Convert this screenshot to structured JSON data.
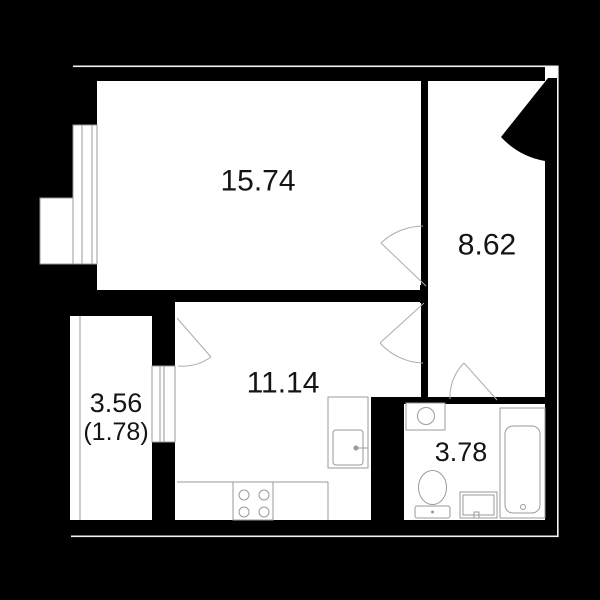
{
  "plan": {
    "canvas": {
      "width": 600,
      "height": 600,
      "background": "#000000"
    },
    "colors": {
      "floor": "#ffffff",
      "wall": "#000000",
      "fixture_line": "#9a9a9a",
      "door_line": "#ababab",
      "outer_hairline": "#f5f5f5",
      "label_text": "#141414"
    },
    "rooms": [
      {
        "name": "living-room",
        "label": "15.74",
        "label_x": 258,
        "label_y": 181,
        "label_size": 30
      },
      {
        "name": "hallway",
        "label": "8.62",
        "label_x": 487,
        "label_y": 245,
        "label_size": 30
      },
      {
        "name": "kitchen",
        "label": "11.14",
        "label_x": 283,
        "label_y": 383,
        "label_size": 30
      },
      {
        "name": "bathroom",
        "label": "3.78",
        "label_x": 461,
        "label_y": 452,
        "label_size": 27
      },
      {
        "name": "balcony",
        "label": "3.56",
        "label_x": 116,
        "label_y": 403,
        "label_size": 27,
        "label2": "(1.78)",
        "label2_x": 116,
        "label2_y": 432,
        "label2_size": 25
      }
    ],
    "shapes": [
      {
        "t": "rect",
        "name": "living-room-floor",
        "x": 97,
        "y": 81,
        "w": 324,
        "h": 209,
        "fill": "floor"
      },
      {
        "t": "rect",
        "name": "hallway-floor",
        "x": 428,
        "y": 81,
        "w": 117,
        "h": 316,
        "fill": "floor"
      },
      {
        "t": "rect",
        "name": "kitchen-floor",
        "x": 175,
        "y": 302,
        "w": 246,
        "h": 218,
        "fill": "floor"
      },
      {
        "t": "rect",
        "name": "balcony-floor",
        "x": 70,
        "y": 316,
        "w": 82,
        "h": 204,
        "fill": "floor"
      },
      {
        "t": "rect",
        "name": "bathroom-floor",
        "x": 404,
        "y": 404,
        "w": 141,
        "h": 117,
        "fill": "floor"
      },
      {
        "t": "rect",
        "name": "wall-top",
        "x": 73,
        "y": 67,
        "w": 472,
        "h": 14,
        "fill": "wall"
      },
      {
        "t": "rect",
        "name": "wall-left-upper",
        "x": 73,
        "y": 81,
        "w": 24,
        "h": 45,
        "fill": "wall"
      },
      {
        "t": "rect",
        "name": "wall-left-lower",
        "x": 73,
        "y": 264,
        "w": 24,
        "h": 26,
        "fill": "wall"
      },
      {
        "t": "rect",
        "name": "wall-living-balcony",
        "x": 70,
        "y": 290,
        "w": 105,
        "h": 26,
        "fill": "wall"
      },
      {
        "t": "rect",
        "name": "wall-balcony-pier-top",
        "x": 152,
        "y": 290,
        "w": 23,
        "h": 28,
        "fill": "wall"
      },
      {
        "t": "rect",
        "name": "wall-balcony-pier-bot",
        "x": 152,
        "y": 442,
        "w": 23,
        "h": 78,
        "fill": "wall"
      },
      {
        "t": "rect",
        "name": "wall-living-kitchen",
        "x": 175,
        "y": 290,
        "w": 253,
        "h": 12,
        "fill": "wall"
      },
      {
        "t": "rect",
        "name": "wall-hall-living",
        "x": 421,
        "y": 81,
        "w": 7,
        "h": 144,
        "fill": "wall"
      },
      {
        "t": "rect",
        "name": "wall-door-cap",
        "x": 420,
        "y": 285,
        "w": 8,
        "h": 18,
        "fill": "wall"
      },
      {
        "t": "rect",
        "name": "wall-hall-kitchen-stub",
        "x": 421,
        "y": 363,
        "w": 7,
        "h": 34,
        "fill": "wall"
      },
      {
        "t": "rect",
        "name": "wall-bottom",
        "x": 70,
        "y": 520,
        "w": 488,
        "h": 16,
        "fill": "wall"
      },
      {
        "t": "rect",
        "name": "wall-right",
        "x": 545,
        "y": 93,
        "w": 12,
        "h": 427,
        "fill": "wall"
      },
      {
        "t": "rect",
        "name": "wall-bath-top-left",
        "x": 371,
        "y": 397,
        "w": 76,
        "h": 7,
        "fill": "wall"
      },
      {
        "t": "rect",
        "name": "wall-bath-top-right",
        "x": 497,
        "y": 397,
        "w": 60,
        "h": 7,
        "fill": "wall"
      },
      {
        "t": "rect",
        "name": "duct-column",
        "x": 371,
        "y": 397,
        "w": 33,
        "h": 124,
        "fill": "wall"
      },
      {
        "t": "rect",
        "name": "entrance-opening",
        "x": 545,
        "y": 67,
        "w": 12,
        "h": 26,
        "fill": "floor"
      },
      {
        "t": "rect",
        "name": "window-living",
        "x": 73,
        "y": 125,
        "w": 24,
        "h": 139,
        "fill": "floor",
        "stroke": "fixture_line"
      },
      {
        "t": "line",
        "name": "window-living-mullion",
        "x1": 82,
        "y1": 125,
        "x2": 82,
        "y2": 264,
        "stroke": "fixture_line"
      },
      {
        "t": "line",
        "name": "window-living-mullion",
        "x1": 92,
        "y1": 125,
        "x2": 92,
        "y2": 264,
        "stroke": "fixture_line"
      },
      {
        "t": "rect",
        "name": "window-balcony",
        "x": 152,
        "y": 366,
        "w": 23,
        "h": 76,
        "fill": "floor",
        "stroke": "fixture_line"
      },
      {
        "t": "line",
        "name": "window-balcony-mullion",
        "x1": 160,
        "y1": 366,
        "x2": 160,
        "y2": 442,
        "stroke": "fixture_line"
      },
      {
        "t": "line",
        "name": "window-balcony-mullion",
        "x1": 164,
        "y1": 366,
        "x2": 164,
        "y2": 442,
        "stroke": "fixture_line"
      },
      {
        "t": "rect",
        "name": "exterior-ledge",
        "x": 40,
        "y": 198,
        "w": 33,
        "h": 66,
        "fill": "floor",
        "stroke": "fixture_line"
      },
      {
        "t": "line",
        "name": "balcony-glazing-line",
        "x1": 80,
        "y1": 316,
        "x2": 80,
        "y2": 520,
        "stroke": "fixture_line"
      },
      {
        "t": "line",
        "name": "kitchen-counter-line",
        "x1": 177,
        "y1": 482,
        "x2": 328,
        "y2": 482,
        "stroke": "fixture_line"
      },
      {
        "t": "line",
        "name": "kitchen-counter-edge",
        "x1": 328,
        "y1": 482,
        "x2": 328,
        "y2": 520,
        "stroke": "fixture_line"
      },
      {
        "t": "rect",
        "name": "stove",
        "x": 233,
        "y": 482,
        "w": 40,
        "h": 38,
        "fill": "none",
        "stroke": "fixture_line"
      },
      {
        "t": "circle",
        "name": "stove-burner",
        "cx": 244,
        "cy": 495,
        "r": 5,
        "fill": "none",
        "stroke": "fixture_line"
      },
      {
        "t": "circle",
        "name": "stove-burner",
        "cx": 264,
        "cy": 495,
        "r": 5,
        "fill": "none",
        "stroke": "fixture_line"
      },
      {
        "t": "circle",
        "name": "stove-burner",
        "cx": 244,
        "cy": 512,
        "r": 5,
        "fill": "none",
        "stroke": "fixture_line"
      },
      {
        "t": "circle",
        "name": "stove-burner",
        "cx": 264,
        "cy": 512,
        "r": 5,
        "fill": "none",
        "stroke": "fixture_line"
      },
      {
        "t": "rect",
        "name": "kitchen-sink-counter",
        "x": 328,
        "y": 397,
        "w": 40,
        "h": 71,
        "fill": "floor",
        "stroke": "fixture_line"
      },
      {
        "t": "rect",
        "name": "kitchen-sink",
        "x": 333,
        "y": 430,
        "w": 30,
        "h": 35,
        "rx": 3,
        "fill": "none",
        "stroke": "fixture_line"
      },
      {
        "t": "line",
        "name": "kitchen-faucet",
        "x1": 356,
        "y1": 448,
        "x2": 368,
        "y2": 448,
        "stroke": "fixture_line"
      },
      {
        "t": "circle",
        "name": "kitchen-faucet-dot",
        "cx": 356,
        "cy": 448,
        "r": 2.5,
        "fill": "fixture_line"
      },
      {
        "t": "rect",
        "name": "washing-machine",
        "x": 406,
        "y": 403,
        "w": 39,
        "h": 27,
        "fill": "floor",
        "stroke": "fixture_line"
      },
      {
        "t": "circle",
        "name": "washing-machine-drum",
        "cx": 426,
        "cy": 416,
        "r": 8.5,
        "fill": "none",
        "stroke": "fixture_line"
      },
      {
        "t": "rect",
        "name": "toilet-tank",
        "x": 415,
        "y": 506,
        "w": 35,
        "h": 12,
        "rx": 2,
        "fill": "floor",
        "stroke": "fixture_line"
      },
      {
        "t": "ellipse",
        "name": "toilet-bowl",
        "cx": 432.5,
        "cy": 487.5,
        "rx": 14,
        "ry": 17,
        "fill": "floor",
        "stroke": "fixture_line"
      },
      {
        "t": "circle",
        "name": "toilet-button",
        "cx": 432.5,
        "cy": 512,
        "r": 1.5,
        "fill": "fixture_line"
      },
      {
        "t": "rect",
        "name": "bath-sink-outer",
        "x": 460,
        "y": 492,
        "w": 37,
        "h": 26,
        "fill": "floor",
        "stroke": "fixture_line"
      },
      {
        "t": "rect",
        "name": "bath-sink-inner",
        "x": 463,
        "y": 495,
        "w": 31,
        "h": 20,
        "fill": "none",
        "stroke": "fixture_line"
      },
      {
        "t": "rect",
        "name": "bath-sink-leg",
        "x": 474,
        "y": 512,
        "w": 5,
        "h": 6,
        "fill": "none",
        "stroke": "fixture_line"
      },
      {
        "t": "rect",
        "name": "bathtub-outer",
        "x": 500,
        "y": 408,
        "w": 45,
        "h": 110,
        "fill": "floor",
        "stroke": "fixture_line"
      },
      {
        "t": "rect",
        "name": "bathtub-inner",
        "x": 505,
        "y": 426,
        "w": 35,
        "h": 87,
        "rx": 8,
        "fill": "none",
        "stroke": "fixture_line"
      },
      {
        "t": "circle",
        "name": "bathtub-drain",
        "cx": 523,
        "cy": 507,
        "r": 2.5,
        "fill": "none",
        "stroke": "fixture_line"
      },
      {
        "t": "line",
        "name": "living-door-leaf",
        "x1": 426,
        "y1": 286,
        "x2": 381,
        "y2": 243,
        "stroke": "door_line"
      },
      {
        "t": "path",
        "name": "living-door-arc",
        "d": "M381 243 A62 62 0 0 1 423 226",
        "fill": "none",
        "stroke": "door_line"
      },
      {
        "t": "line",
        "name": "kitchen-door-leaf",
        "x1": 424,
        "y1": 303,
        "x2": 380,
        "y2": 343,
        "stroke": "door_line"
      },
      {
        "t": "path",
        "name": "kitchen-door-arc",
        "d": "M380 343 A60 60 0 0 0 423 363",
        "fill": "none",
        "stroke": "door_line"
      },
      {
        "t": "line",
        "name": "balcony-door-leaf",
        "x1": 177,
        "y1": 318,
        "x2": 211,
        "y2": 357,
        "stroke": "door_line"
      },
      {
        "t": "path",
        "name": "balcony-door-arc",
        "d": "M211 357 A50 50 0 0 1 178 366",
        "fill": "none",
        "stroke": "door_line"
      },
      {
        "t": "line",
        "name": "bathroom-door-leaf",
        "x1": 497,
        "y1": 400,
        "x2": 464,
        "y2": 363,
        "stroke": "door_line"
      },
      {
        "t": "path",
        "name": "bathroom-door-arc",
        "d": "M450 399 A48 48 0 0 1 464 363",
        "fill": "none",
        "stroke": "door_line"
      },
      {
        "t": "path",
        "name": "entrance-door",
        "d": "M548 78 L501 137 A78 78 0 0 0 545 161 L557 161 L557 78 Z",
        "fill": "wall",
        "stroke": "none"
      },
      {
        "t": "rect",
        "name": "outer-hairline-top",
        "x": 73,
        "y": 65.5,
        "w": 485.5,
        "h": 1.6,
        "fill": "outer_hairline"
      },
      {
        "t": "rect",
        "name": "outer-hairline-right",
        "x": 557,
        "y": 65.5,
        "w": 1.6,
        "h": 471.5,
        "fill": "outer_hairline"
      },
      {
        "t": "rect",
        "name": "outer-hairline-bottom",
        "x": 71,
        "y": 535.5,
        "w": 487.6,
        "h": 1.6,
        "fill": "outer_hairline"
      }
    ]
  }
}
